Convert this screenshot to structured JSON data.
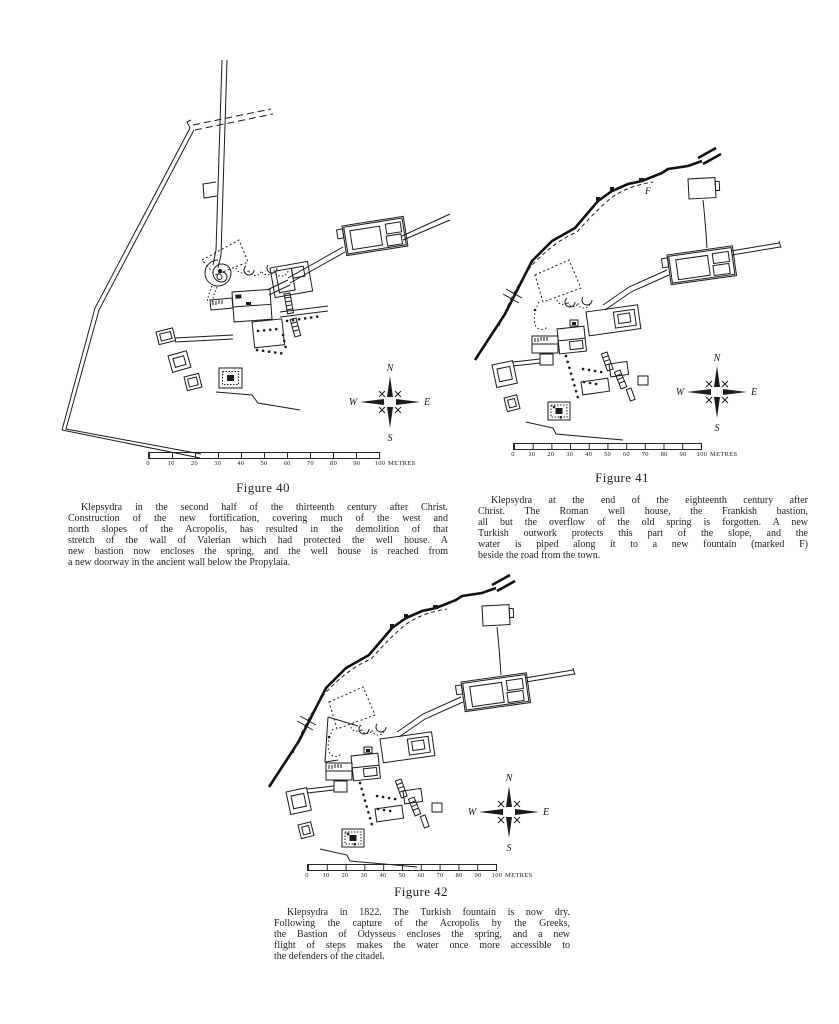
{
  "page_type": "book figure page",
  "ink_color": "#1b1b1b",
  "paper_color": "#ffffff",
  "compass": {
    "n": "N",
    "e": "E",
    "s": "S",
    "w": "W"
  },
  "scalebar": {
    "ticks": [
      "0",
      "10",
      "20",
      "30",
      "40",
      "50",
      "60",
      "70",
      "80",
      "90",
      "100"
    ],
    "unit": "METRES"
  },
  "figures": [
    {
      "label": "Figure 40",
      "caption_lines": [
        "Klepsydra in the second half of the thirteenth century after Christ.",
        "Construction of the new fortification, covering much of the west and",
        "north slopes of the Acropolis, has resulted in the demolition of that",
        "stretch of the wall of Valerian which had protected the well house. A",
        "new bastion now encloses the spring, and the well house is reached from",
        "a new doorway in the ancient wall below the Propylaia."
      ]
    },
    {
      "label": "Figure 41",
      "map_label_f": "F",
      "caption_lines": [
        "Klepsydra at the end of the eighteenth century after",
        "Christ.  The Roman well house, the Frankish bastion,",
        "all but the overflow of the old spring is forgotten.  A new",
        "Turkish outwork protects this part of the slope, and the",
        "water is piped along it to a new fountain (marked F)",
        "beside the road from the town."
      ]
    },
    {
      "label": "Figure 42",
      "caption_lines": [
        "Klepsydra in 1822.  The Turkish fountain is now dry.",
        "Following the capture of the Acropolis by the Greeks,",
        "the Bastion of Odysseus encloses the spring, and a new",
        "flight of steps makes the water once more accessible to",
        "the defenders of the citadel."
      ]
    }
  ]
}
